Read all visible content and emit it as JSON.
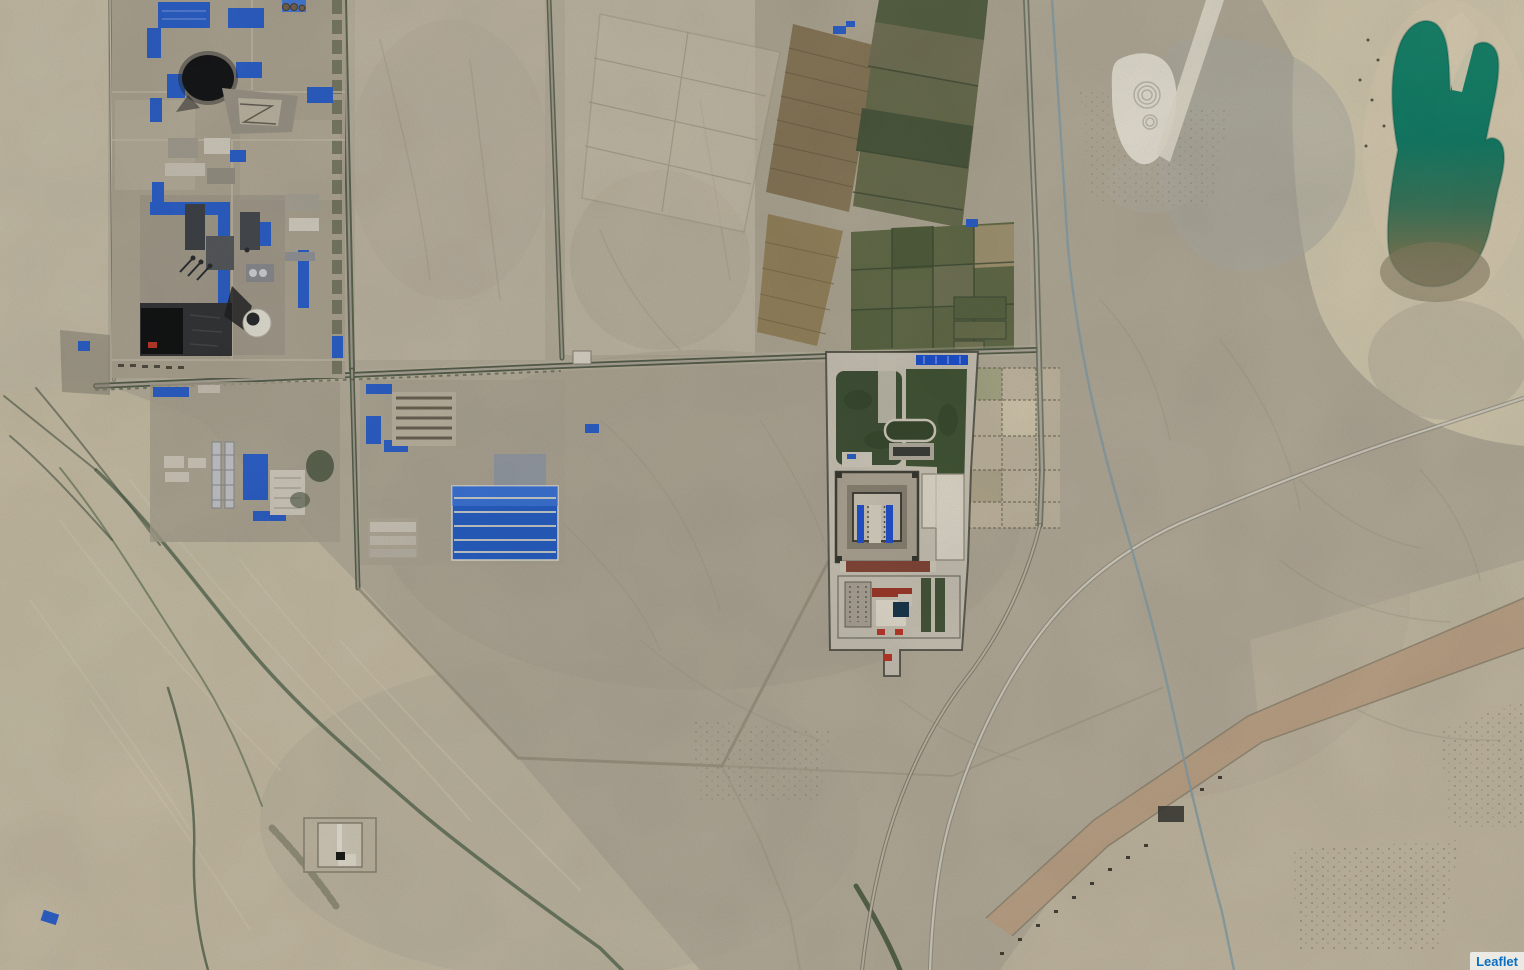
{
  "map": {
    "kind": "satellite-imagery-tile-view",
    "attribution_text": "Leaflet"
  },
  "palette": {
    "sand_base": "#bfb7a4",
    "sand_light": "#cdc4ad",
    "sand_pale": "#d9cfb4",
    "desert_gray": "#b3aa97",
    "road_dark": "#55604a",
    "road_light": "#b2ac9e",
    "tree_green": "#4e5942",
    "field_green": "#66704c",
    "field_brown": "#8d7c5c",
    "compound_green": "#44553a",
    "roof_blue": "#2f64cf",
    "roof_blue_bright": "#1f56d8",
    "water_teal": "#1a8a70",
    "coal_black": "#17181a",
    "building_white": "#e2dccd",
    "red_accent": "#c33b2c",
    "canal_blue": "#8ba4ac",
    "dirt_tan": "#c3a98c",
    "attribution_blue": "#0a6fc2"
  },
  "features": [
    "coal-power-plant",
    "smoke-plume",
    "coal-pile",
    "cooling-tower",
    "industrial-yards",
    "blue-roof-warehouse",
    "farm-field-grid",
    "empty-parcels",
    "detention-compound",
    "prison-block",
    "compound-green-yard",
    "perimeter-wall",
    "east-parcel-grid",
    "highway",
    "irrigation-canal",
    "white-road",
    "dirt-strip-road",
    "river-wash-channels",
    "green-pond",
    "quarry",
    "walled-square-structure",
    "vehicle-track"
  ]
}
